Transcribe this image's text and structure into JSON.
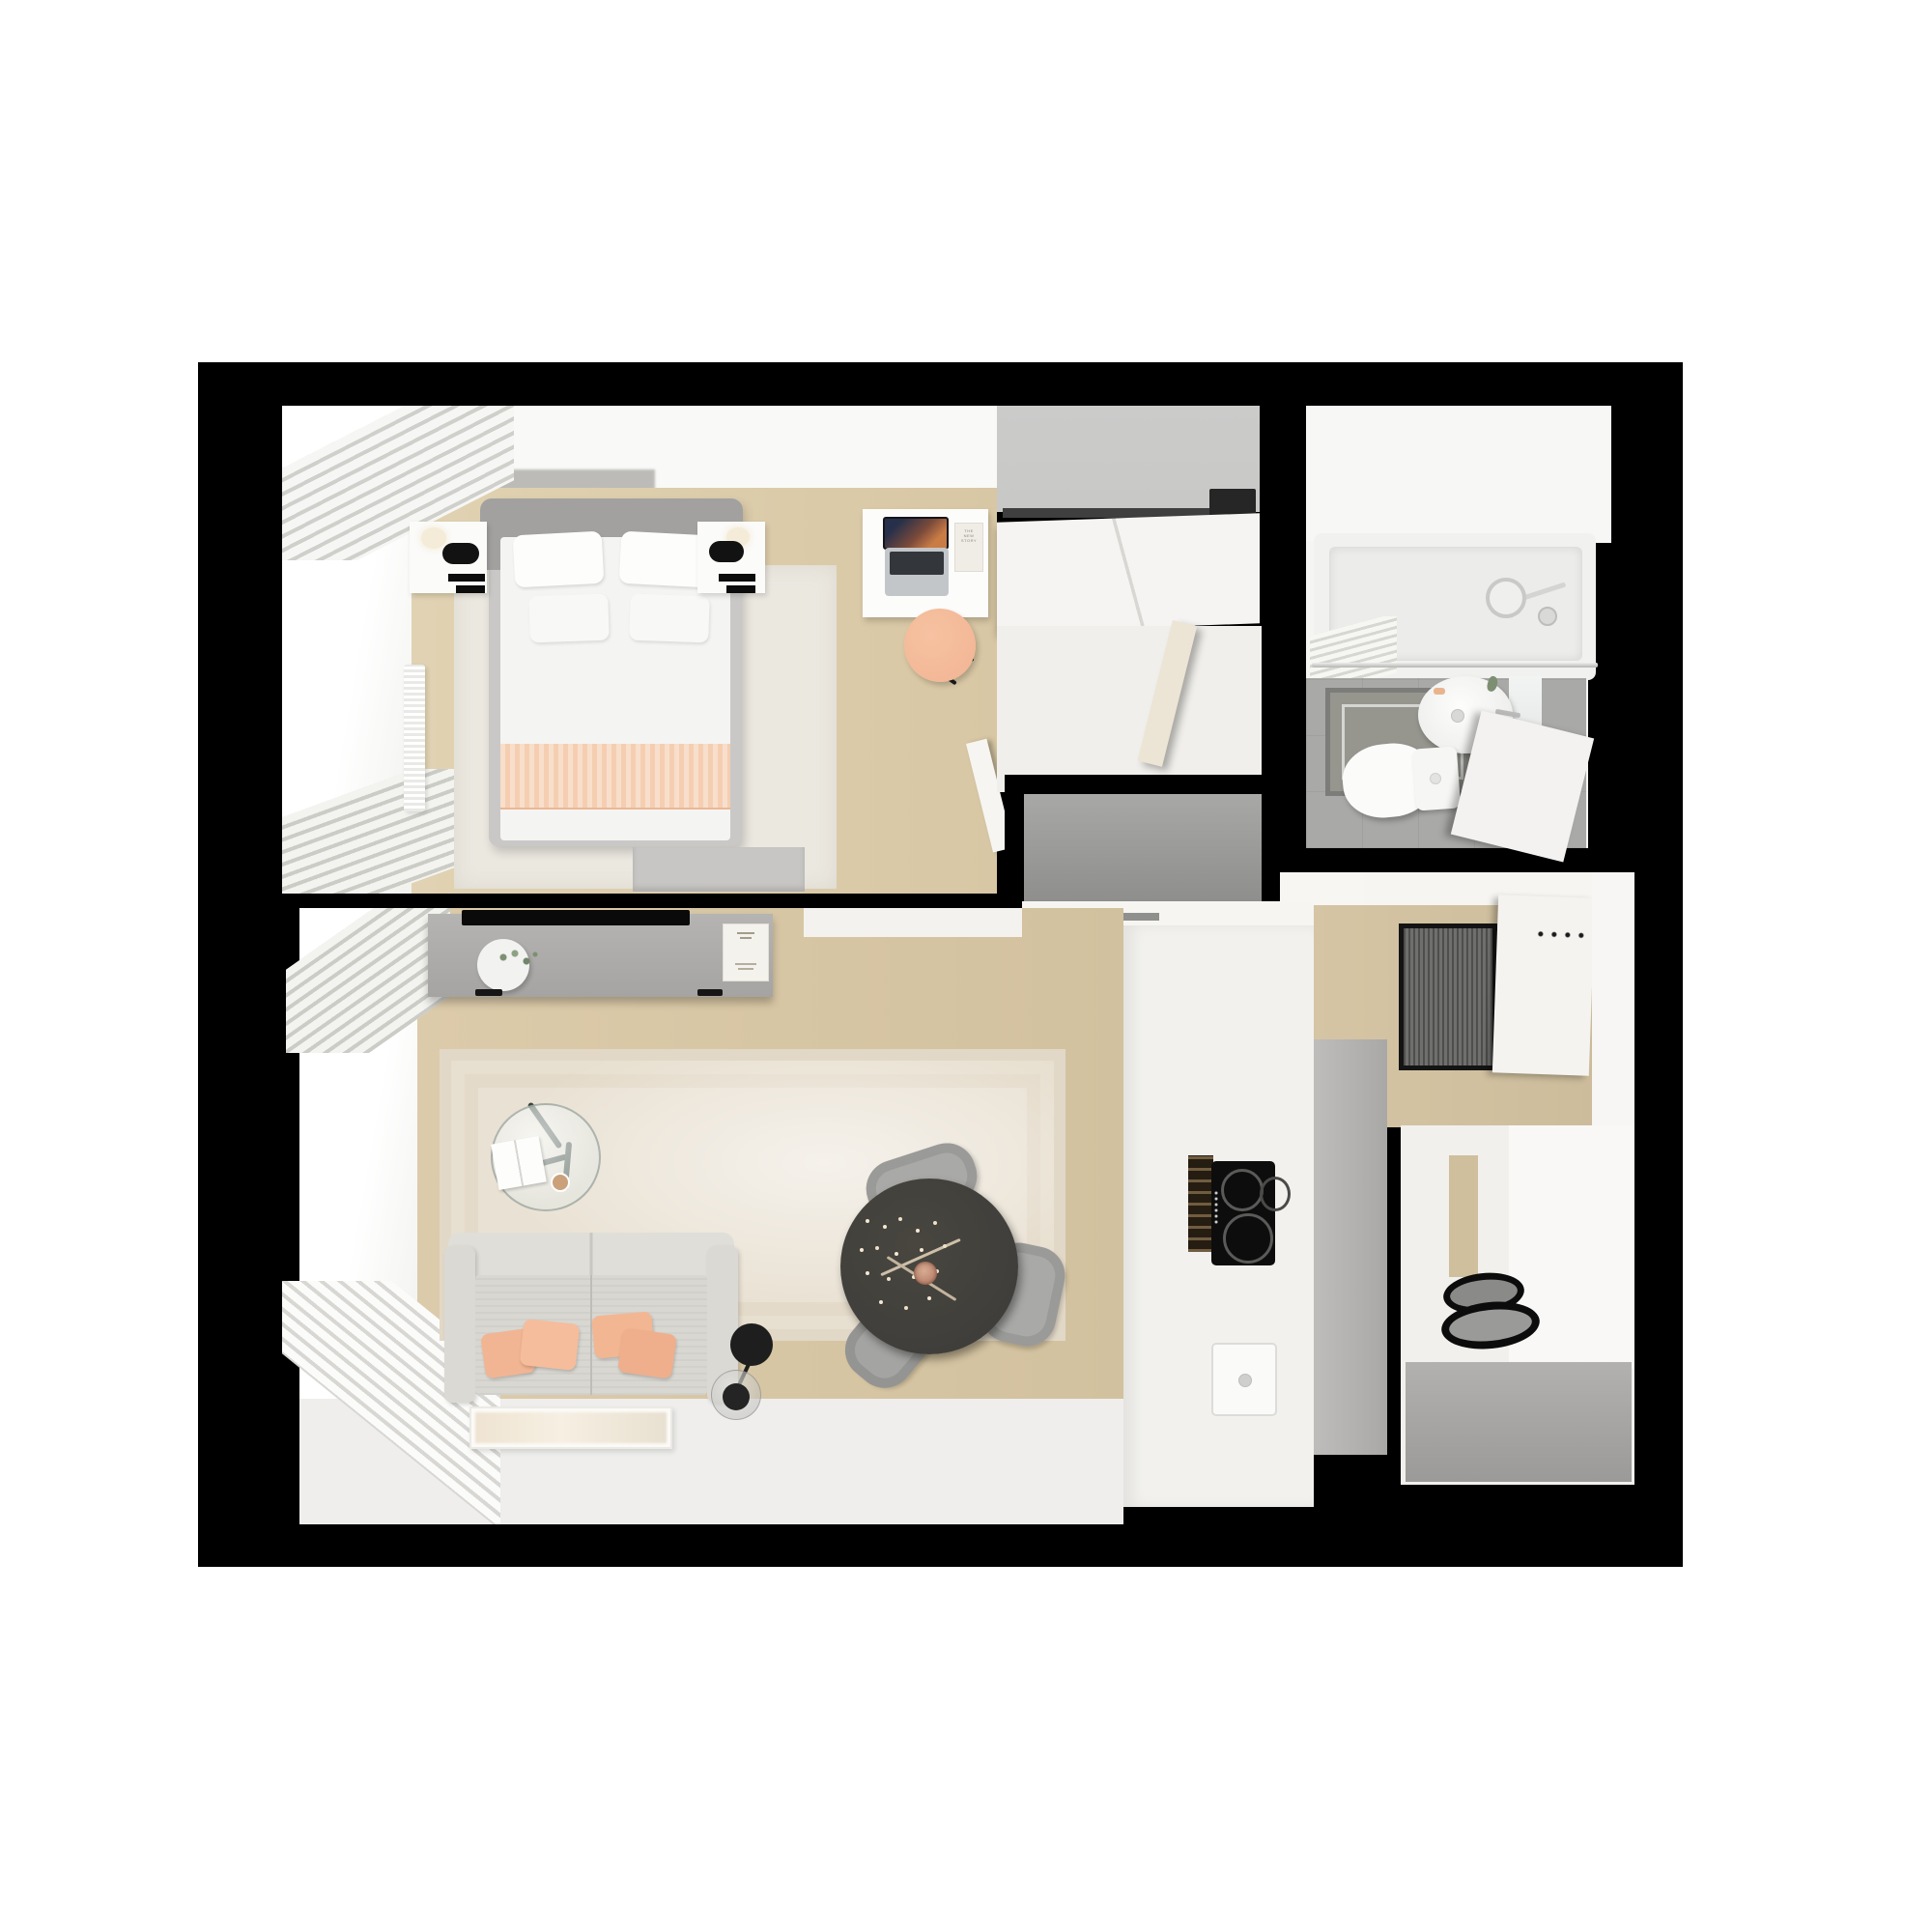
{
  "scene": {
    "description": "Top-down 3D rendered floor plan of a small studio apartment on a black background",
    "view": "top-down interior render",
    "rooms_count": 5
  },
  "texts": {
    "desk_booklet": "THE NEW STORY"
  },
  "palette": {
    "page": "#ffffff",
    "canvas": "#000000",
    "wall": "#f9f9f7",
    "wood": "#d8c7a4",
    "wood_dark": "#cfbf9d",
    "gray_wall": "#c8c8c6",
    "slab_gray": "#9a9a98",
    "console_gray": "#aeadab",
    "sofa_gray": "#d9d7d1",
    "peach": "#f2b592",
    "blanket_peach": "#f5ceb1",
    "table_dark": "#403e3b",
    "chair_gray": "#a9a9a7",
    "bath_floor": "#a9a9a7",
    "bath_mat": "#96968f",
    "doormat": "#6f6f6d",
    "cooktop": "#0d0d0d",
    "fridge_gray": "#b3b2b0",
    "rug_living": "#e9e1d3",
    "rug_bedroom": "#ebe8e0",
    "lamp_black": "#1e1e1e",
    "chair_peach": "#f3b897",
    "headboard_gray": "#a2a1a0"
  },
  "rooms": {
    "bedroom": {
      "name": "Bedroom",
      "items": [
        "double bed",
        "gray headboard",
        "white pillows",
        "peach blanket",
        "two nightstands",
        "black wall sconces",
        "cream table lamps",
        "white area rug",
        "white desk",
        "laptop",
        "booklet",
        "peach desk chair",
        "sliding-door wardrobe",
        "window with roman blind",
        "radiator",
        "curtains",
        "wall artwork",
        "low dresser",
        "open door"
      ]
    },
    "bathroom": {
      "name": "Bathroom",
      "items": [
        "bathtub",
        "shower curtain",
        "chrome shower fixture",
        "round washbasin",
        "mirror",
        "toilet",
        "gray bath mat",
        "gray tile floor",
        "open door",
        "plant sprig"
      ]
    },
    "hallway": {
      "name": "Entry hall",
      "items": [
        "ribbed doormat",
        "entry door with hooks",
        "wood floor",
        "gray storage top"
      ]
    },
    "kitchen": {
      "name": "Kitchen",
      "items": [
        "induction cooktop",
        "built-in oven",
        "sink with drain",
        "tall gray fridge panel",
        "white counters",
        "two-burner hob",
        "gray cabinet fronts"
      ]
    },
    "living_room": {
      "name": "Living room / dining",
      "items": [
        "gray TV sideboard",
        "flat TV",
        "plant pot",
        "art book",
        "beige patterned rug",
        "round glass coffee table",
        "open magazine",
        "cup",
        "two-seat gray sofa",
        "four peach cushions",
        "black disc floor lamp",
        "painting lying on floor",
        "window with curtains",
        "radiator",
        "round dark dining table",
        "flower branch centerpiece",
        "three gray tub chairs"
      ]
    }
  }
}
